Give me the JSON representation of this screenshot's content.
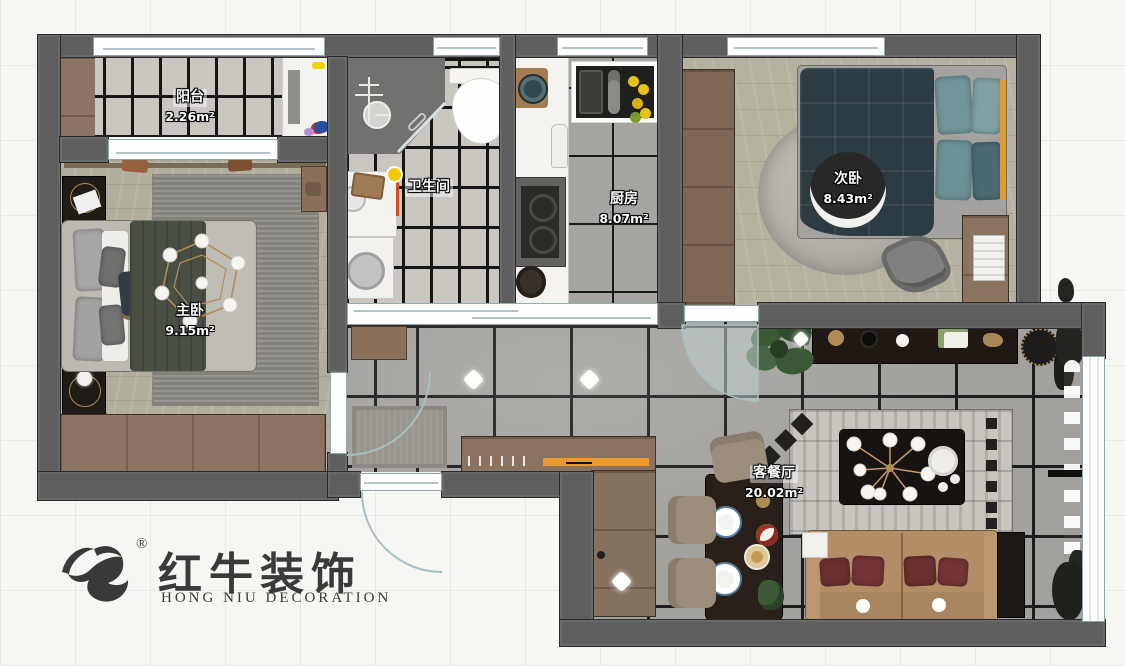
{
  "brand": {
    "name_cn": "红牛装饰",
    "name_en": "HONG NIU DECORATION",
    "registered_mark": "®"
  },
  "rooms": {
    "balcony": {
      "name": "阳台",
      "area": "2.26",
      "area_unit": "m²"
    },
    "master_bedroom": {
      "name": "主卧",
      "area": "9.15",
      "area_unit": "m²"
    },
    "bathroom": {
      "name": "卫生间"
    },
    "kitchen": {
      "name": "厨房",
      "area": "8.07",
      "area_unit": "m²"
    },
    "second_bedroom": {
      "name": "次卧",
      "area": "8.43",
      "area_unit": "m²"
    },
    "living_dining": {
      "name": "客餐厅",
      "area": "20.02",
      "area_unit": "m²"
    }
  },
  "palette": {
    "wall_gray": "#5e5e5e",
    "tile_light": "#c9c6c0",
    "tile_gray": "#a3a19d",
    "wood_floor": "#b2ae9e",
    "accent_orange": "#eb9b2e",
    "bed_teal": "#2d3b43",
    "sofa_tan": "#b08b63",
    "logo_gray": "#3a3a3a"
  }
}
